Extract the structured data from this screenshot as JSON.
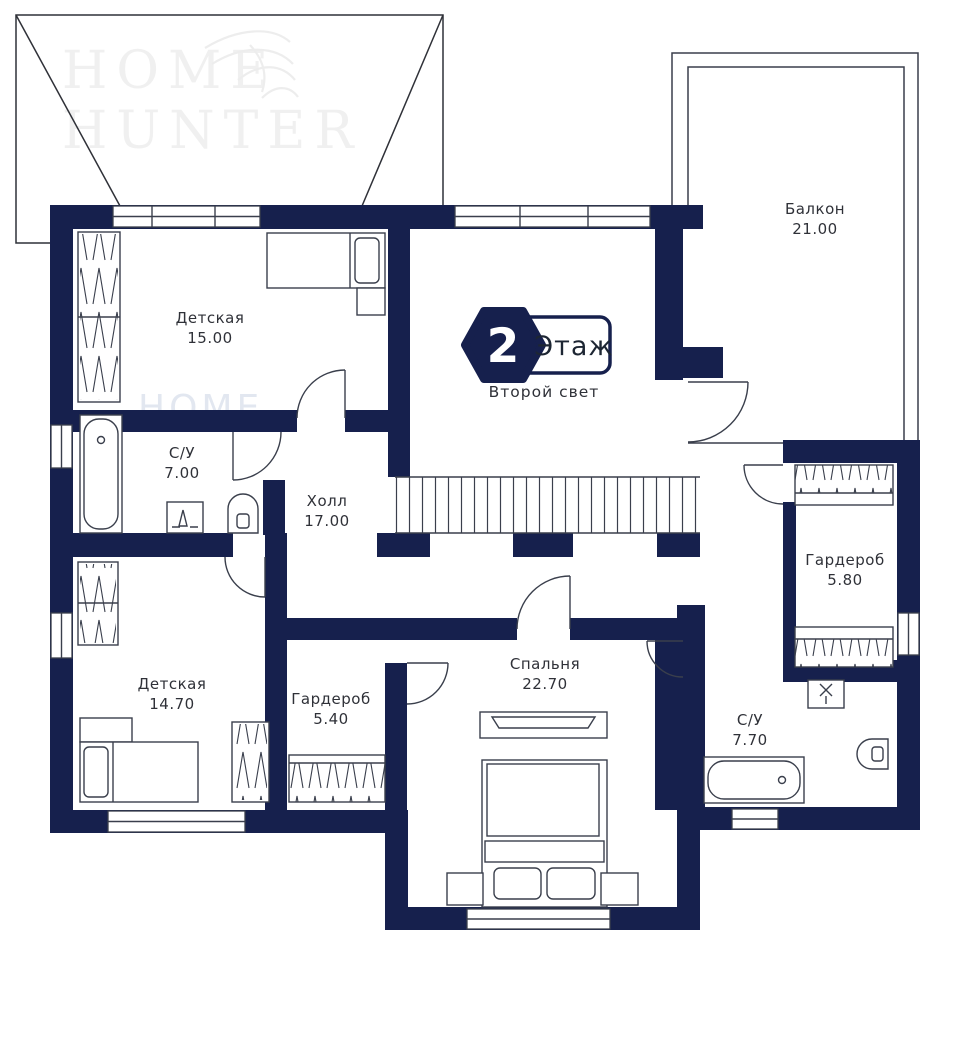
{
  "brand": {
    "line1": "HOME",
    "line2": "HUNTER"
  },
  "floor_badge": {
    "number": "2",
    "label": "Этаж",
    "subtitle": "Второй свет"
  },
  "rooms": [
    {
      "id": "nursery-1",
      "name": "Детская",
      "area": "15.00"
    },
    {
      "id": "balcony",
      "name": "Балкон",
      "area": "21.00"
    },
    {
      "id": "bathroom-1",
      "name": "С/У",
      "area": "7.00"
    },
    {
      "id": "hall",
      "name": "Холл",
      "area": "17.00"
    },
    {
      "id": "wardrobe-1",
      "name": "Гардероб",
      "area": "5.80"
    },
    {
      "id": "nursery-2",
      "name": "Детская",
      "area": "14.70"
    },
    {
      "id": "wardrobe-2",
      "name": "Гардероб",
      "area": "5.40"
    },
    {
      "id": "bedroom",
      "name": "Спальня",
      "area": "22.70"
    },
    {
      "id": "bathroom-2",
      "name": "С/У",
      "area": "7.70"
    }
  ],
  "colors": {
    "wall": "#16204d",
    "line": "#3a3f4c"
  }
}
